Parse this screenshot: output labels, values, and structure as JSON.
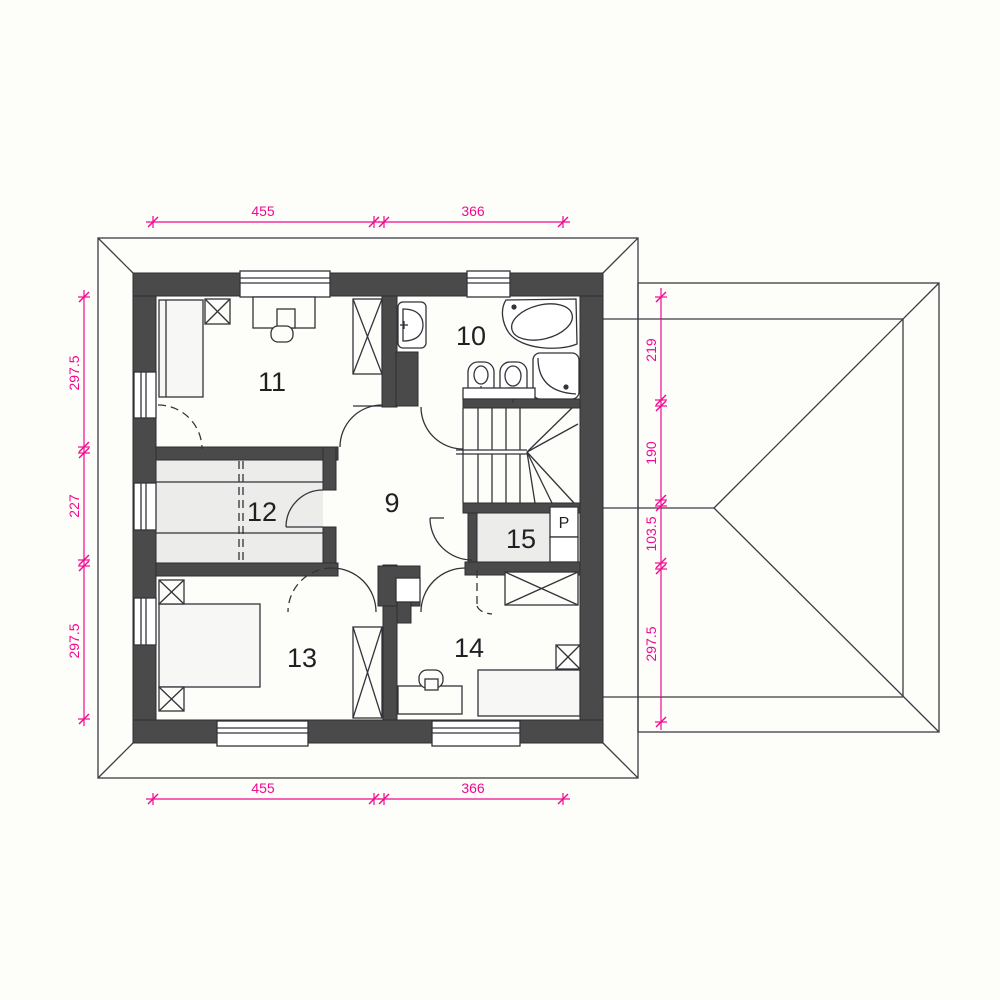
{
  "title": "Floor plan – upper storey",
  "colors": {
    "background": "#fdfdfa",
    "wall": "#4a4a4b",
    "line": "#33333a",
    "dimension": "#f10991",
    "room_fill": "#ececeb"
  },
  "rooms": {
    "hall": {
      "label": "9"
    },
    "bathroom": {
      "label": "10"
    },
    "bedroom_top_left": {
      "label": "11"
    },
    "wardrobe_room": {
      "label": "12"
    },
    "bedroom_bottom_left": {
      "label": "13"
    },
    "bedroom_bottom_right": {
      "label": "14"
    },
    "laundry": {
      "label": "15",
      "p_label": "P"
    }
  },
  "dimensions": {
    "top": {
      "seg1": "455",
      "seg2": "366"
    },
    "bottom": {
      "seg1": "455",
      "seg2": "366"
    },
    "left": {
      "seg1": "297.5",
      "seg2": "227",
      "seg3": "297.5"
    },
    "right": {
      "seg1": "219",
      "seg2": "190",
      "seg3": "103.5",
      "seg4": "297.5"
    }
  }
}
